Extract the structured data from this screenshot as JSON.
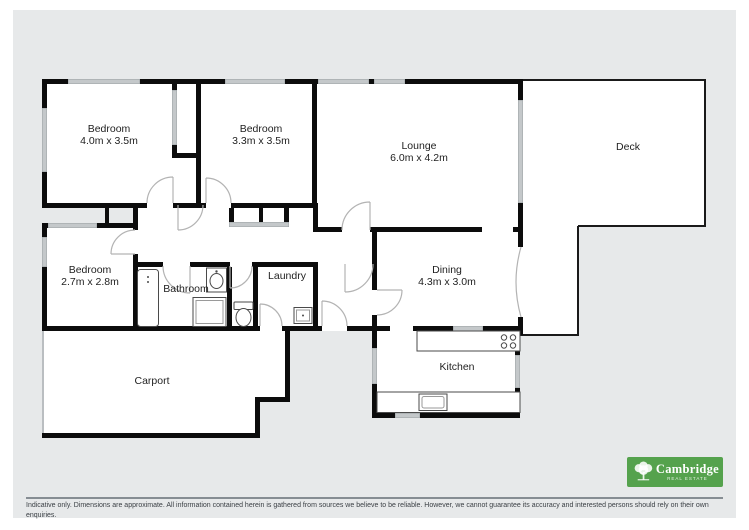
{
  "plan": {
    "rooms": [
      {
        "id": "bedroom-1",
        "label": "Bedroom",
        "dims": "4.0m x 3.5m"
      },
      {
        "id": "bedroom-2",
        "label": "Bedroom",
        "dims": "3.3m x 3.5m"
      },
      {
        "id": "lounge",
        "label": "Lounge",
        "dims": "6.0m x 4.2m"
      },
      {
        "id": "deck",
        "label": "Deck",
        "dims": ""
      },
      {
        "id": "bedroom-3",
        "label": "Bedroom",
        "dims": "2.7m x 2.8m"
      },
      {
        "id": "bathroom",
        "label": "Bathroom",
        "dims": ""
      },
      {
        "id": "laundry",
        "label": "Laundry",
        "dims": ""
      },
      {
        "id": "dining",
        "label": "Dining",
        "dims": "4.3m x 3.0m"
      },
      {
        "id": "kitchen",
        "label": "Kitchen",
        "dims": ""
      },
      {
        "id": "carport",
        "label": "Carport",
        "dims": ""
      }
    ]
  },
  "footer": {
    "disclaimer": "Indicative only. Dimensions are approximate. All information contained herein is gathered from sources we believe to be reliable. However, we cannot guarantee its accuracy and interested persons should rely on their own enquiries.",
    "logo": {
      "name": "Cambridge",
      "tagline": "Real Estate"
    }
  },
  "colors": {
    "panel_bg": "#e7e9ea",
    "room_fill": "#ffffff",
    "wall": "#0c0c0c",
    "window": "#c4c8ca",
    "arc": "#b3b3b3",
    "fixture": "#4a4a4a",
    "logo_green": "#55a24d"
  }
}
